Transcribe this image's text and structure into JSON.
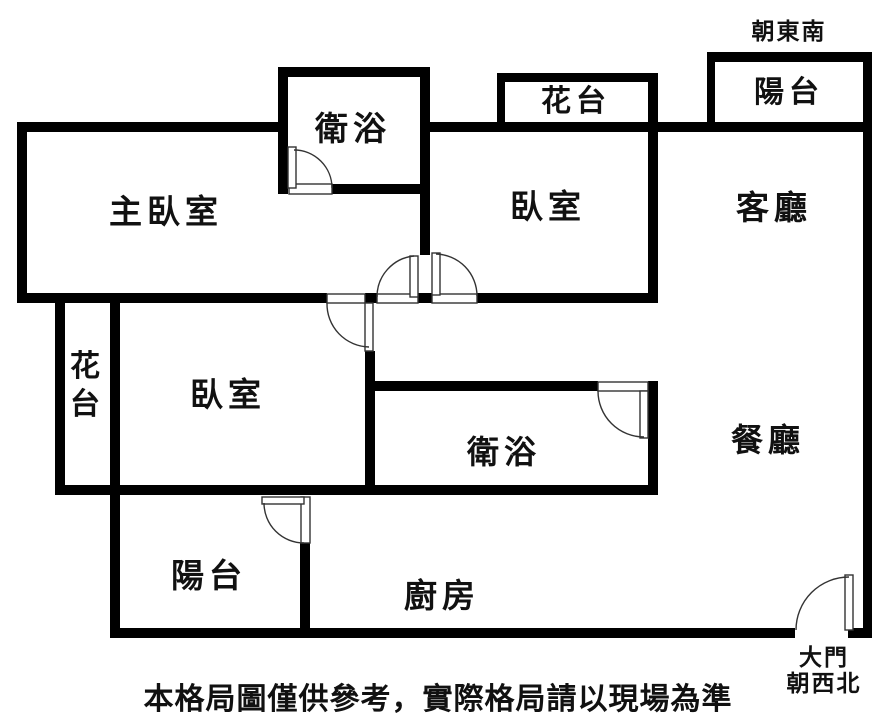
{
  "orientation_note": "朝東南",
  "rooms": {
    "balcony_top": "陽台",
    "flower_bed_top": "花台",
    "bathroom_top": "衛浴",
    "master_bedroom": "主臥室",
    "bedroom_top": "臥室",
    "living_room": "客廳",
    "flower_bed_left": "花台",
    "bedroom_mid": "臥室",
    "bathroom_mid": "衛浴",
    "dining_room": "餐廳",
    "balcony_bottom": "陽台",
    "kitchen": "廚房"
  },
  "main_door": {
    "line1": "大門",
    "line2": "朝西北"
  },
  "caption": "本格局圖僅供參考，實際格局請以現場為準",
  "colors": {
    "wall": "#000000",
    "door_line": "#333333",
    "background": "#ffffff",
    "text": "#111111"
  }
}
